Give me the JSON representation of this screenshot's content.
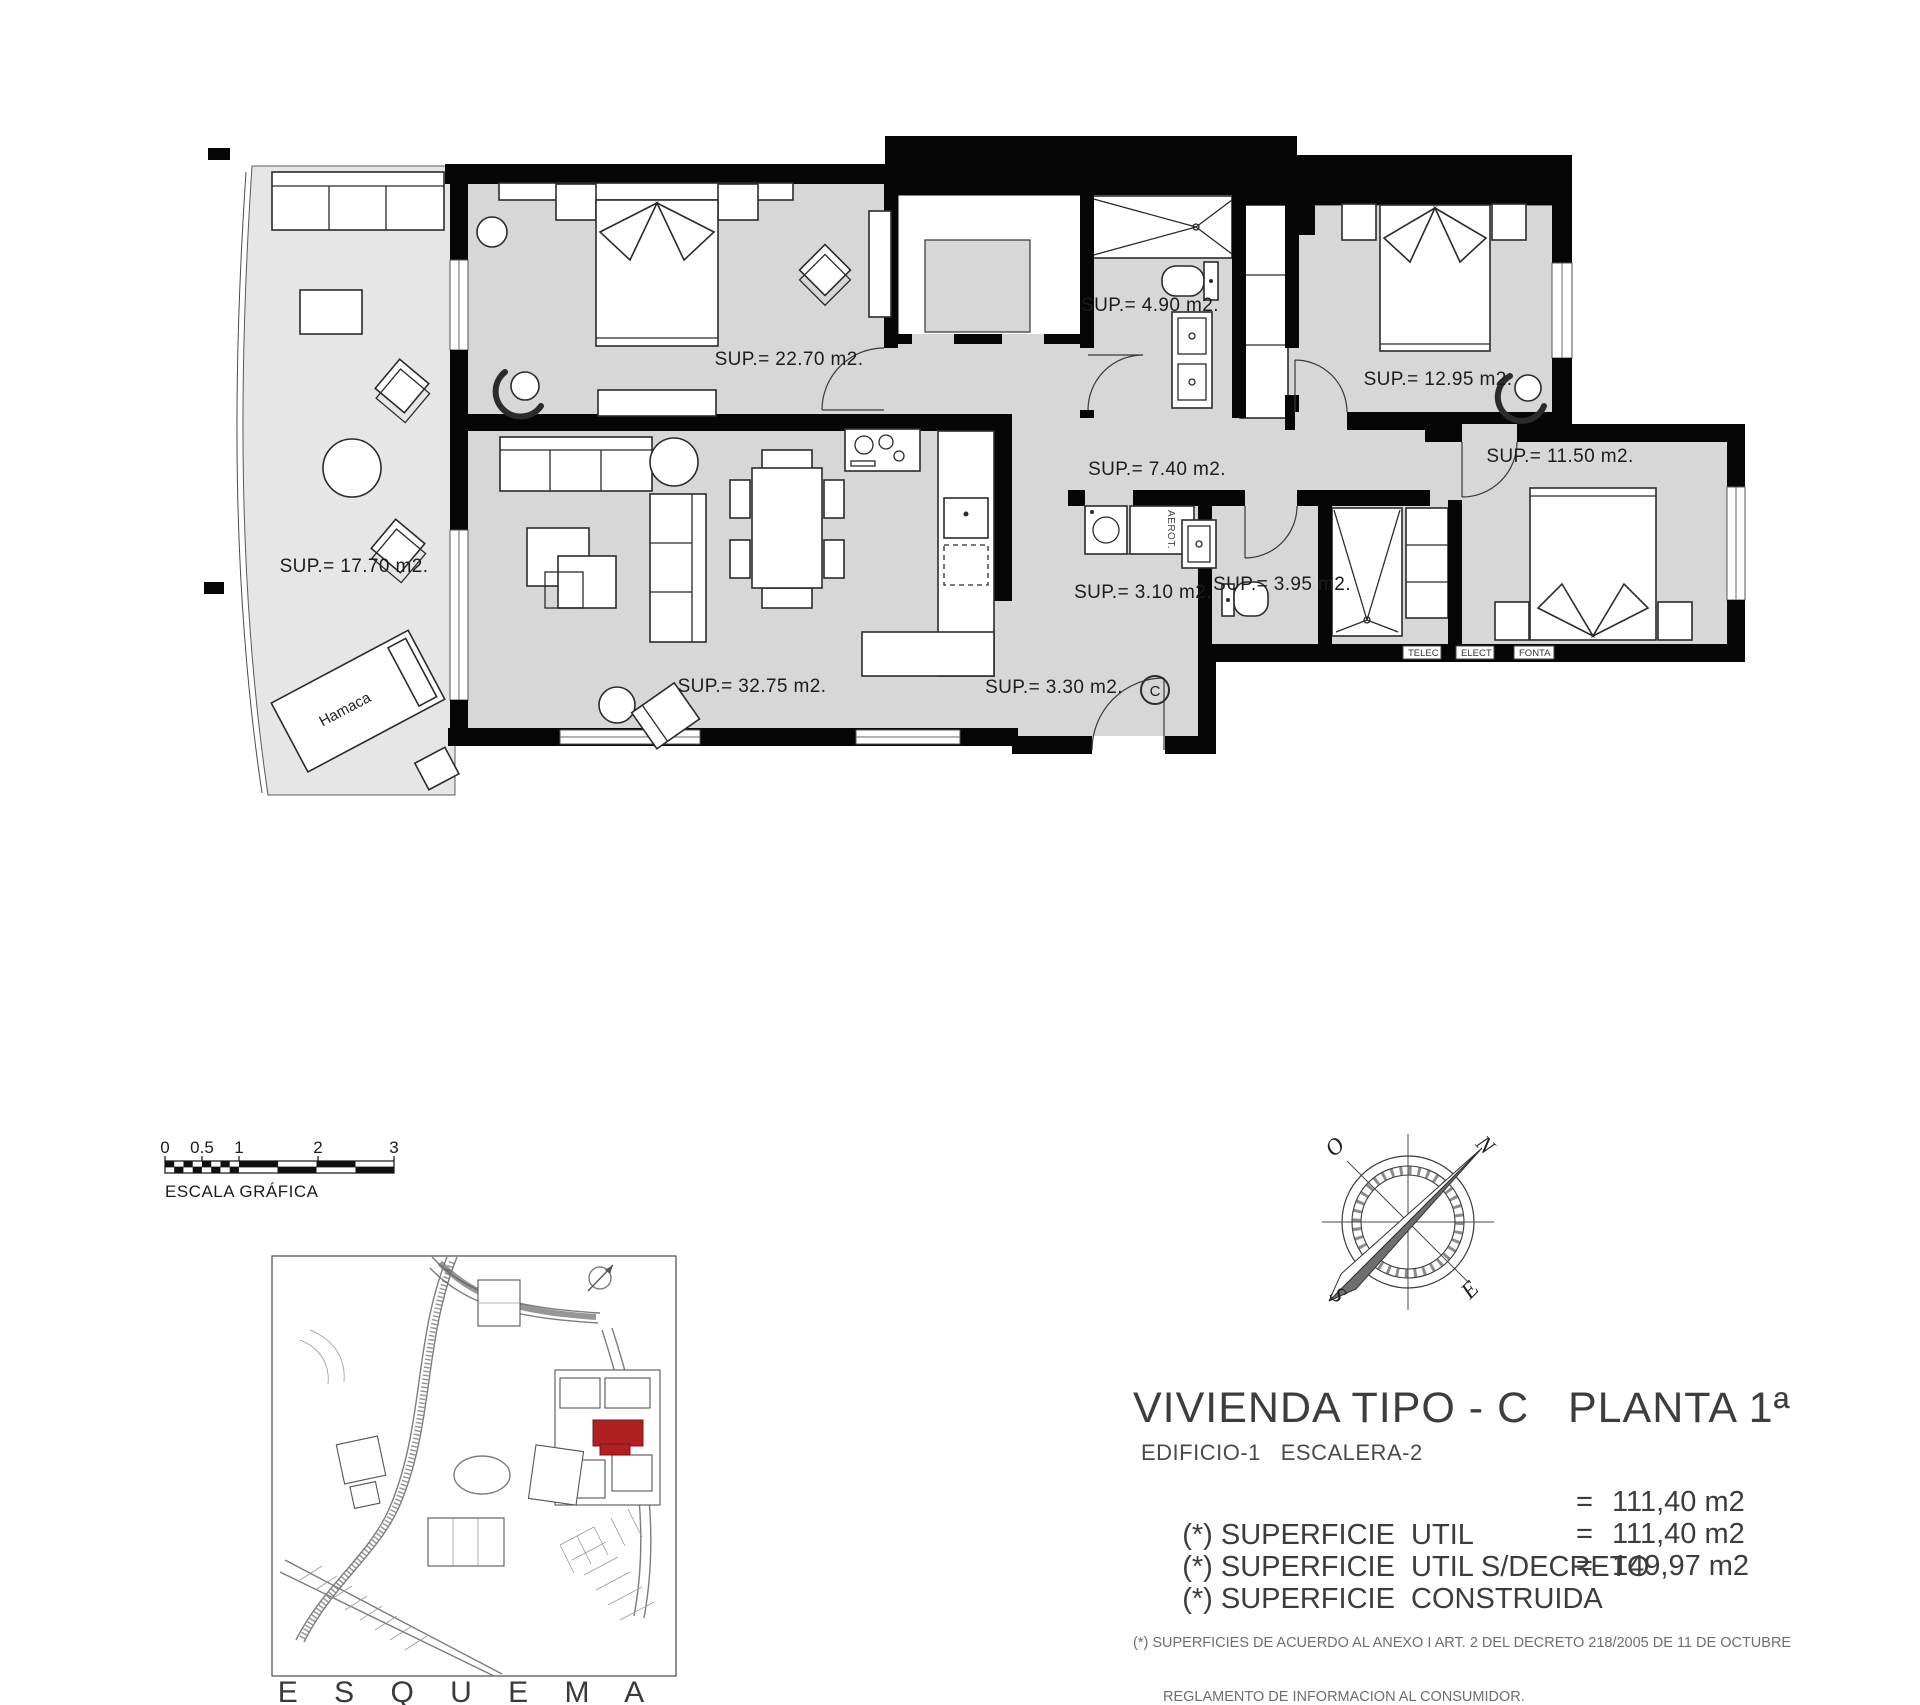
{
  "plan": {
    "room_labels": [
      "SUP.= 17.70 m2.",
      "SUP.= 22.70 m2.",
      "SUP.= 4.90 m2.",
      "SUP.= 12.95 m2.",
      "SUP.= 7.40 m2.",
      "SUP.= 11.50 m2.",
      "SUP.= 3.10 m2.",
      "SUP.= 3.95 m2.",
      "SUP.= 32.75 m2.",
      "SUP.= 3.30 m2."
    ],
    "hamaca_label": "Hamaca",
    "aerot_label": "AEROT.",
    "unit_marker": "C",
    "utility_boxes": [
      "TELEC",
      "ELECT",
      "FONTA"
    ]
  },
  "scale_bar": {
    "ticks": [
      "0",
      "0.5",
      "1",
      "2",
      "3"
    ],
    "label": "ESCALA GRÁFICA"
  },
  "site_plan": {
    "caption": "E S Q U E M A"
  },
  "compass": {
    "n": "N",
    "s": "S",
    "e": "E",
    "o": "O"
  },
  "title_block": {
    "title": "VIVIENDA TIPO - C   PLANTA 1ª",
    "subtitle": "EDIFICIO-1   ESCALERA-2",
    "rows": [
      {
        "label": "(*) SUPERFICIE  UTIL",
        "eq": "=",
        "value": "111,40 m2"
      },
      {
        "label": "(*) SUPERFICIE  UTIL S/DECRETO",
        "eq": "=",
        "value": "111,40 m2"
      },
      {
        "label": "(*) SUPERFICIE  CONSTRUIDA",
        "eq": "=",
        "value": "149,97 m2"
      }
    ],
    "footnote_line1": "(*) SUPERFICIES DE ACUERDO AL ANEXO I ART. 2 DEL DECRETO 218/2005 DE 11 DE OCTUBRE",
    "footnote_line2": "REGLAMENTO DE INFORMACION AL CONSUMIDOR."
  },
  "colors": {
    "wall": "#060606",
    "floor": "#d7d7d7",
    "terrace": "#e6e6e6",
    "highlight": "#b02020"
  }
}
